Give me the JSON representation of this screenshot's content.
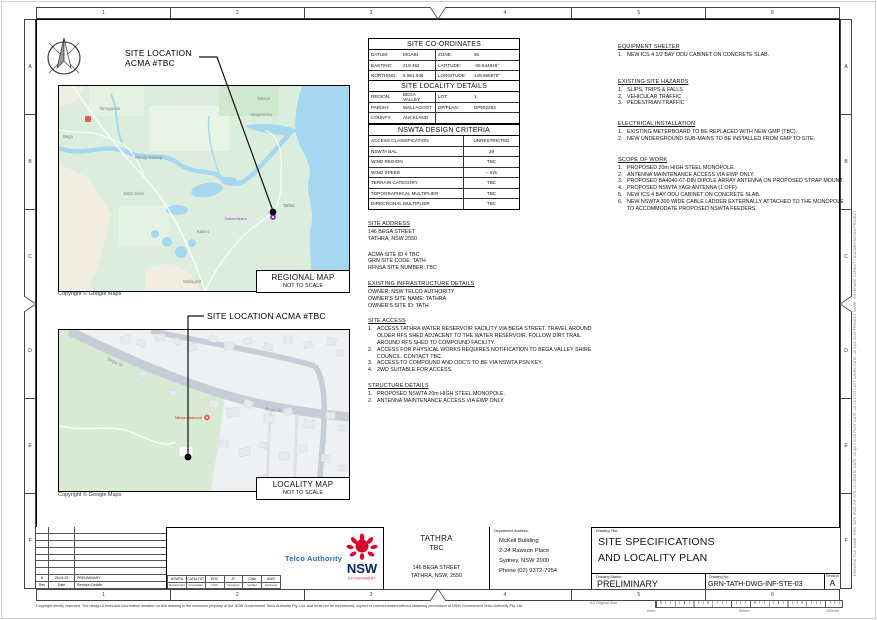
{
  "sheet": {
    "cols": [
      "1",
      "2",
      "3",
      "4",
      "5",
      "6"
    ],
    "rows": [
      "A",
      "B",
      "C",
      "D",
      "E",
      "F"
    ],
    "copyright": "Copyright strictly reserved. The design & technical information detailed on this drawing is the exclusive property of the NSW Government Telco Authority Pty. Ltd. and must not be reproduced, copied or communicated without obtaining permission of NSW Government Telco Authority Pty. Ltd.",
    "size_label": "A3 Original Size",
    "ruler_start": "0mm",
    "ruler_mid": "50mm",
    "ruler_end": "100mm",
    "edge_note": "DRAWING FILE NAME: GRN-TATH-DWG-INF-STE-03   CREATE DATE: 28 April 2025   PLOT DATE: 28-04-2025   LAST SAVED DATE: 28 April 2025   PROJECT NAME: COVERAGE CAPACITY AUGMENTATION PROJECT"
  },
  "regional_map": {
    "callout_line1": "SITE LOCATION",
    "callout_line2": "ACMA #TBC",
    "labels": [
      "Tarraganda",
      "Nelson",
      "Mogareeka",
      "Bega",
      "Reedy Swamp",
      "Jellat Jellat",
      "Kalaru",
      "Tathra",
      "Wallagoot"
    ],
    "poi_purple": "Tathra Beach",
    "copyright": "Copyright © Google Maps",
    "caption": "REGIONAL MAP",
    "caption_sub": "NOT TO SCALE"
  },
  "locality_map": {
    "callout": "SITE LOCATION ACMA #TBC",
    "road_label": "Bega St",
    "poi_red": "Tathra reservoir",
    "copyright": "Copyright © Google Maps",
    "caption": "LOCALITY MAP",
    "caption_sub": "NOT TO SCALE"
  },
  "coordinates_table": {
    "title": "SITE CO-ORDINATES",
    "rows": [
      [
        "DATUM:",
        "MGA94",
        "ZONE:",
        "56"
      ],
      [
        "EASTING:",
        "219 452",
        "LATITUDE:",
        "-36.544848°"
      ],
      [
        "NORTHING:",
        "5 951 046",
        "LONGITUDE:",
        "149.865970°"
      ]
    ]
  },
  "locality_table": {
    "title": "SITE LOCALITY DETAILS",
    "rows": [
      [
        "REGION:",
        "BEGA VALLEY",
        "LOT:",
        "1"
      ],
      [
        "PARISH:",
        "WALLAGOOT",
        "DP/PLAN:",
        "DP502253"
      ],
      [
        "COUNTY:",
        "AUCKLAND",
        "",
        ""
      ]
    ]
  },
  "criteria_table": {
    "title": "NSWTA DESIGN CRITERIA",
    "rows": [
      [
        "ACCESS CLASSIFICATION",
        "UNRESTRICTED"
      ],
      [
        "NSWTA BAL",
        "29"
      ],
      [
        "WIND REGION",
        "TBC"
      ],
      [
        "WIND SPEED",
        "– m/s"
      ],
      [
        "TERRAIN CATEGORY",
        "TBC"
      ],
      [
        "TOPOGRAPHICAL MULTIPLIER",
        "TBC"
      ],
      [
        "DIRECTIONAL MULTIPLIER",
        "TBC"
      ]
    ]
  },
  "mid_notes": {
    "site_address": {
      "heading": "SITE ADDRESS",
      "lines": [
        "146 BEGA STREET",
        "TATHRA, NSW 2550"
      ]
    },
    "site_ids": {
      "lines": [
        "ACMA SITE ID # TBC",
        "GRN SITE CODE: TATH",
        "RFNSA SITE NUMBER:  TBC"
      ]
    },
    "existing_infra": {
      "heading": "EXISTING INFRASTRUCTURE DETAILS",
      "lines": [
        "OWNER: NSW TELCO AUTHORITY",
        "OWNER'S SITE NAME: TATHRA",
        "OWNER'S SITE ID: TATH"
      ]
    },
    "site_access": {
      "heading": "SITE ACCESS",
      "items": [
        "ACCESS TATHRA WATER RESERVOIR FACILITY VIA BEGA STREET. TRAVEL AROUND OLDER RFS SHED ADJACENT TO THE WATER RESERVOIR. FOLLOW DIRT TRAIL AROUND RFS SHED TO COMPOUND FACILITY.",
        "ACCESS FOR PHYSICAL WORKS REQUIRES NOTIFICATION TO BEGA VALLEY SHIRE COUNCIL. CONTACT TBC.",
        "ACCESS TO COMPOUND AND ODC'S TO BE VIA NSWTA PSN KEY.",
        "2WD SUITABLE FOR ACCESS."
      ]
    },
    "structure_details": {
      "heading": "STRUCTURE DETAILS",
      "items": [
        "PROPOSED NSWTA 20m HIGH STEEL MONOPOLE.",
        "ANTENNA MAINTENANCE ACCESS VIA EWP ONLY."
      ]
    }
  },
  "right_notes": {
    "equipment_shelter": {
      "heading": "EQUIPMENT SHELTER",
      "items": [
        "NEW ICS 4 1/2 BAY ODU CABINET ON CONCRETE SLAB."
      ]
    },
    "site_hazards": {
      "heading": "EXISTING SITE HAZARDS",
      "items": [
        "SLIPS, TRIPS & FALLS",
        "VEHICULAR TRAFFIC",
        "PEDESTRIAN TRAFFIC"
      ]
    },
    "electrical": {
      "heading": "ELECTRICAL INSTALLATION",
      "items": [
        "EXISTING METERBOARD TO BE REPLACED WITH NEW GMP (TBC).",
        "NEW UNDERGROUND SUB-MAINS TO BE INSTALLED FROM GMP TO SITE."
      ]
    },
    "scope": {
      "heading": "SCOPE OF WORK",
      "items": [
        "PROPOSED 20m HIGH STEEL MONOPOLE.",
        "ANTENNA MAINTENANCE ACCESS VIA EWP ONLY.",
        "PROPOSED BA4040-67-DIN DIPOLE ARRAY ANTENNA ON PROPOSED STRAP MOUNT.",
        "PROPOSED NSWTA YAGI ANTENNA (1 OFF).",
        "NEW ICS 4 BAY ODU CABINET ON CONCRETE SLAB.",
        "NEW NSWTA 300 WIDE CABLE LADDER EXTERNALLY ATTACHED TO THE MONOPOLE TO ACCOMMODATE PROPOSED NSWTA FEEDERS."
      ]
    }
  },
  "title_block": {
    "revision_row": {
      "rev": "A",
      "date": "28.04.25",
      "details": "PRELIMINARY"
    },
    "revision_headers": {
      "rev": "Rev",
      "date": "Date",
      "details": "Revision Details"
    },
    "approvals": {
      "values": [
        "NSWTA",
        "CATALYST",
        "DRC",
        "JF",
        "CWe",
        "AWG"
      ],
      "labels": [
        "Department",
        "Consultant",
        "CAD",
        "Designer",
        "Verifier",
        "Approver"
      ]
    },
    "brand": {
      "name": "Telco Authority",
      "logo_text": "NSW",
      "logo_sub": "GOVERNMENT"
    },
    "site": {
      "name": "TATHRA",
      "code": "TBC",
      "address1": "146 BEGA STREET",
      "address2": "TATHRA, NSW, 2550"
    },
    "dept": {
      "label": "Department Address:",
      "lines": [
        "McKell Building",
        "2-24 Rawson Place",
        "Sydney, NSW 2000",
        "Phone (02) 9372-7954"
      ]
    },
    "drawing": {
      "title_label": "Drawing Title:",
      "title1": "SITE SPECIFICATIONS",
      "title2": "AND LOCALITY PLAN",
      "status_label": "Drawing Status:",
      "status": "PRELIMINARY",
      "number_label": "Drawing No.",
      "number": "GRN-TATH-DWG-INF-STE-03",
      "rev_label": "Revision",
      "revision": "A"
    }
  },
  "colors": {
    "telco_blue": "#2a6db5",
    "nsw_navy": "#002664",
    "waratah_red": "#e4002b",
    "sea": "#a6d7f0",
    "park_green": "#d7ebd3"
  }
}
